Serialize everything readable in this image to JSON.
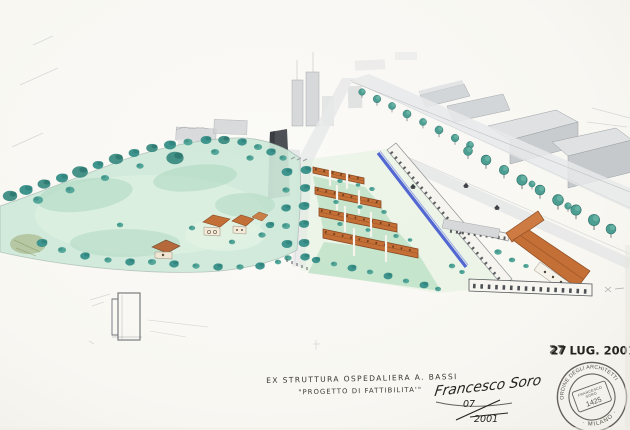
{
  "captions": {
    "line1": "EX STRUTTURA OSPEDALIERA A. BASSI",
    "line2": "\"PROGETTO DI FATTIBILITA'\""
  },
  "date_stamp": {
    "day": "27",
    "rest": "LUG. 2001"
  },
  "signature": {
    "name": "Francesco Soro",
    "frac_top": "07",
    "frac_bottom": "2001"
  },
  "seal": {
    "ring_top": "ORDINE DEGLI ARCHITETTI",
    "ring_bottom": "· MILANO ·",
    "center_line1": "FRANCESCO",
    "center_line2": "SORO",
    "center_number": "1425"
  },
  "colors": {
    "paper": "#f8f7f2",
    "park_green": "#cfe9da",
    "tree_teal": "#3f958d",
    "roof_orange": "#c46f36",
    "gallery_blue": "#4a5fd0",
    "city_gray": "#d3d6d8",
    "ink": "#26231f",
    "seal_ink": "#56514b"
  }
}
